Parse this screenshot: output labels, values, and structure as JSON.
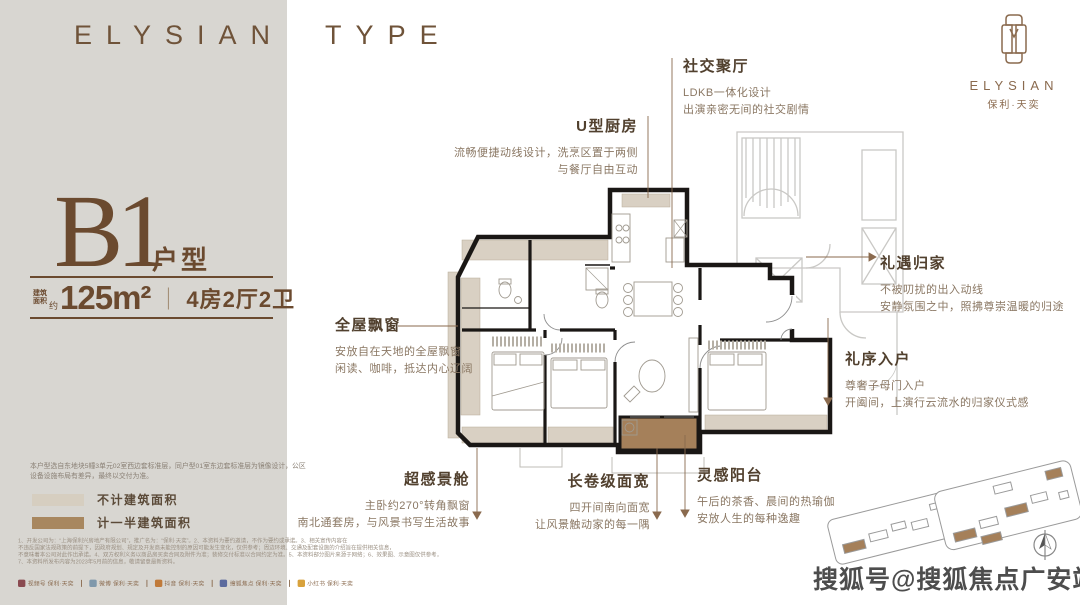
{
  "brand": {
    "title": "ELYSIAN TYPE"
  },
  "logo": {
    "wordmark": "ELYSIAN",
    "cn_name": "保利·天奕"
  },
  "unit": {
    "code": "B1",
    "code_suffix": "户型",
    "area_prefix_top": "建筑",
    "area_prefix_bottom": "面积",
    "area_approx": "约",
    "area_value": "125m²",
    "separator": "｜",
    "rooms": "4房2厅2卫"
  },
  "annotations": {
    "social": {
      "title": "社交聚厅",
      "line1": "LDKB一体化设计",
      "line2": "出演亲密无间的社交剧情"
    },
    "kitchen": {
      "title": "U型厨房",
      "line1": "流畅便捷动线设计，洗烹区置于两侧",
      "line2": "与餐厅自由互动"
    },
    "bay": {
      "title": "全屋飘窗",
      "line1": "安放自在天地的全屋飘窗",
      "line2": "闲读、咖啡，抵达内心辽阔"
    },
    "homecoming": {
      "title": "礼遇归家",
      "line1": "不被叨扰的出入动线",
      "line2": "安静氛围之中，照拂尊崇温暖的归途"
    },
    "entry": {
      "title": "礼序入户",
      "line1": "尊奢子母门入户",
      "line2": "开阖间，上演行云流水的归家仪式感"
    },
    "master": {
      "title": "超感景舱",
      "line1": "主卧约270°转角飘窗",
      "line2": "南北通套房，与风景书写生活故事"
    },
    "span": {
      "title": "长卷级面宽",
      "line1": "四开间南向面宽",
      "line2": "让风景触动家的每一隅"
    },
    "balcony": {
      "title": "灵感阳台",
      "line1": "午后的茶香、晨间的热瑜伽",
      "line2": "安放人生的每种逸趣"
    }
  },
  "note": {
    "line1": "本户型选自东地块5幢3单元02室西边套标准层，同户型01室东边套标准层为镜像设计，公区",
    "line2": "设备设施布局有差异，最终以交付为准。"
  },
  "legend": {
    "item1": {
      "label": "不计建筑面积",
      "color": "#d6cec0"
    },
    "item2": {
      "label": "计一半建筑面积",
      "color": "#a8875f"
    }
  },
  "fine_print": {
    "line1": "1、开发公司为：“上海保利兴房地产有限公司”，推广名为：“保利·天奕”。2、本资料为要约邀请，不作为要约或承诺。3、相关宣传内容在",
    "line2": "不违反国家法规政策的前提下，因政府规划、规定及开发商未能控制的原因可能发生变化，仅供参考；周边环境、交通及配套设施的介绍旨在提供相关信息，",
    "line3": "不意味着本公司对此作出承诺。4、双方权利义务以商品房买卖合同及附件为准；装修交付标准以合同约定为准。5、本资料部分图片来源于网络；6、效果图、示意图仅供参考，",
    "line4": "7、本资料所发布内容为2023年5月前的信息，敬请留意最新资料。"
  },
  "social": {
    "separator": "丨",
    "items": [
      {
        "label": "视频号 保利·天奕",
        "color": "#8a4a50"
      },
      {
        "label": "微博 保利·天奕",
        "color": "#7f98ab"
      },
      {
        "label": "抖音 保利·天奕",
        "color": "#c07a3a"
      },
      {
        "label": "搜狐焦点 保利·天奕",
        "color": "#5c6b9e"
      },
      {
        "label": "小红书 保利·天奕",
        "color": "#d8a23c"
      }
    ]
  },
  "watermark": {
    "text": "搜狐号@搜狐焦点广安站"
  },
  "colors": {
    "accent_brown": "#6b4a2f",
    "panel_bg": "#d8d6d1",
    "wall_black": "#1a1715",
    "bay_beige": "#d9d0c3",
    "balcony_brown": "#a5805a",
    "neighbor_gray": "#c9c8c5",
    "leader_line": "#8a6a4e"
  }
}
